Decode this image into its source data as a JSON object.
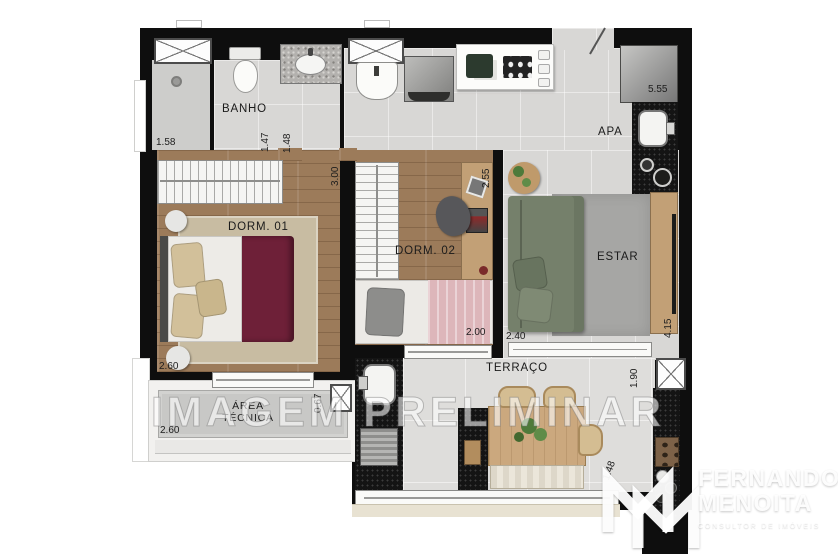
{
  "watermark": "IMAGEM PRELIMINAR",
  "labels": {
    "banho": "BANHO",
    "apa": "APA",
    "dorm1": "DORM. 01",
    "dorm2": "DORM. 02",
    "estar": "ESTAR",
    "terraco": "TERRAÇO",
    "area_tecnica": "ÁREA TÉCNICA"
  },
  "dimensions": {
    "shower": "1.58",
    "banho_left": "1.47",
    "banho_right": "1.48",
    "kitchen_counter": "5.55",
    "dorm1_depth": "3.00",
    "dorm1_width": "2.60",
    "dorm2_depth": "2.55",
    "dorm2_bed": "2.00",
    "estar_width": "2.40",
    "estar_depth": "4.15",
    "terraco_depth": "1.90",
    "terraco_counter": "1.48",
    "area_tecnica_width": "2.60",
    "area_tecnica_depth": "0.67"
  },
  "logo": {
    "line1": "FERNANDO",
    "line2": "MENOITA",
    "tagline": "CONSULTOR DE IMÓVEIS"
  },
  "colors": {
    "wall": "#0e0e0e",
    "tile_floor": "#d8d7d5",
    "terrace_floor": "#dedddb",
    "wood_floor": "#9c7b5a",
    "desk_wood": "#c2a076",
    "rug_dorm1": "#c8bca2",
    "rug_estar": "#a6a6a4",
    "bed1_cover": "#6e2038",
    "bed2_blanket": "#ddb6ba",
    "sofa": "#75806b",
    "counter_black": "#141414",
    "plant_green": "#4e7a3a"
  }
}
